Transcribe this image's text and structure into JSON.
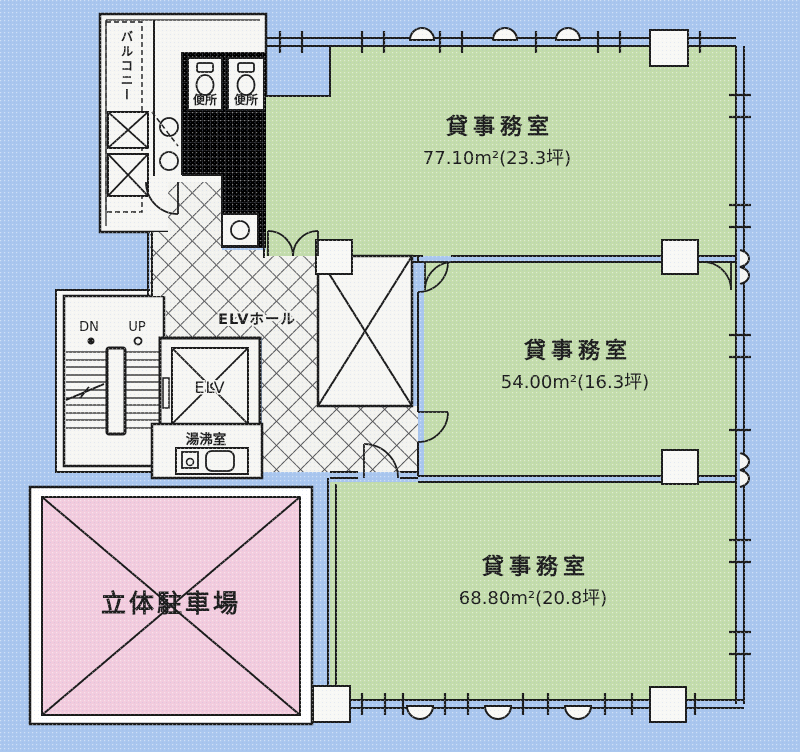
{
  "colors": {
    "background": "#a9c6ee",
    "room_green": "#c3dcab",
    "parking_pink": "#f2cbdd",
    "floor_white": "#f6f6f3",
    "line": "#1a1a1a"
  },
  "rooms": [
    {
      "name": "貸事務室",
      "area": "77.10m²(23.3坪)"
    },
    {
      "name": "貸事務室",
      "area": "54.00m²(16.3坪)"
    },
    {
      "name": "貸事務室",
      "area": "68.80m²(20.8坪)"
    }
  ],
  "parking": {
    "label": "立体駐車場"
  },
  "core": {
    "elevator_hall": "ELVホール",
    "elevator": "ELV",
    "kitchenette": "湯沸室",
    "toilet1": "便所",
    "toilet2": "便所",
    "balcony": "バルコニー",
    "stairs_down": "DN",
    "stairs_up": "UP"
  }
}
